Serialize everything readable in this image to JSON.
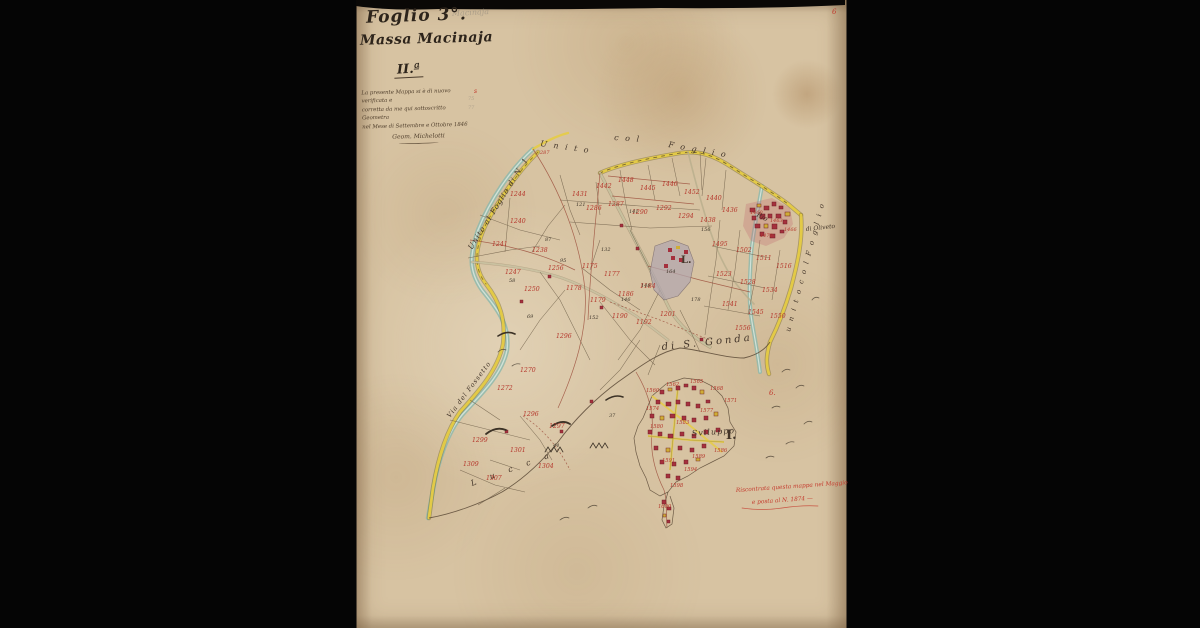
{
  "window": {
    "background": "#050505"
  },
  "sheet": {
    "paper_color": "#d7c3a2",
    "edge_color": "#0f0a06"
  },
  "title_block": {
    "sheet_no": "Foglio 3°.",
    "place_name": "Massa Macinaja",
    "series_mark": "II.ª",
    "certification_lines": [
      "La presente Mappa si è di nuovo verificata e",
      "corretta da me qui sottoscritto Geometra",
      "nel Mese di Settembre e Ottobre 1846"
    ],
    "signature": "Geom. Michelotti"
  },
  "map": {
    "colors": {
      "road_yellow": "#e6cc45",
      "stream_blue": "#8fb8ac",
      "building_red": "#a5303d",
      "building_yellow": "#cfad36",
      "ink": "#44362a",
      "red_number": "#b5372c",
      "gray_wash": "#b3a7ae"
    },
    "labels": [
      {
        "t": "U n i t o",
        "x": 540,
        "y": 146,
        "r": 8,
        "s": 8,
        "ls": 2
      },
      {
        "t": "c o l",
        "x": 614,
        "y": 140,
        "r": 4,
        "s": 8,
        "ls": 2
      },
      {
        "t": "F o g l i o",
        "x": 668,
        "y": 147,
        "r": 10,
        "s": 8,
        "ls": 2
      },
      {
        "t": "Unito al Foglio di N. 1",
        "x": 472,
        "y": 250,
        "r": -58,
        "s": 7.5,
        "ls": 1
      },
      {
        "t": "Via del Fossetto",
        "x": 450,
        "y": 418,
        "r": -53,
        "s": 6.5,
        "ls": 1
      },
      {
        "t": "L  u  c  c  a",
        "x": 472,
        "y": 486,
        "r": -20,
        "s": 8,
        "ls": 6
      },
      {
        "t": "di S. Gonda",
        "x": 662,
        "y": 350,
        "r": -6,
        "s": 10,
        "ls": 3
      },
      {
        "t": "u n i t o  c o l  F o g l i o",
        "x": 790,
        "y": 332,
        "r": -75,
        "s": 7,
        "ls": 2
      },
      {
        "t": "Rio",
        "x": 756,
        "y": 216,
        "r": 28,
        "s": 7
      },
      {
        "t": "di Oliveto",
        "x": 806,
        "y": 231,
        "r": -6,
        "s": 6
      },
      {
        "t": "Sviluppo",
        "x": 692,
        "y": 436,
        "r": -4,
        "s": 8,
        "ls": 1
      },
      {
        "t": "I.",
        "x": 726,
        "y": 439,
        "s": 13,
        "b": 1,
        "it": 0
      },
      {
        "t": "L.",
        "x": 681,
        "y": 263,
        "s": 10,
        "b": 1,
        "it": 0
      },
      {
        "t": "Macinaja",
        "x": 452,
        "y": 16,
        "s": 8,
        "c": "#8a8378",
        "o": 0.5,
        "r": -3
      },
      {
        "t": "75",
        "x": 468,
        "y": 100,
        "s": 5,
        "c": "#8a8378",
        "o": 0.5
      },
      {
        "t": "77",
        "x": 468,
        "y": 109,
        "s": 5,
        "c": "#8a8378",
        "o": 0.5
      },
      {
        "t": "6",
        "x": 832,
        "y": 14,
        "s": 7,
        "c": "#c23b2e"
      },
      {
        "t": "s",
        "x": 474,
        "y": 93,
        "s": 6,
        "c": "#c23b2e"
      },
      {
        "t": "6.",
        "x": 769,
        "y": 395,
        "s": 7,
        "c": "#c23b2e"
      },
      {
        "t": "Riscontrata questa mappa nel Maggio",
        "x": 736,
        "y": 492,
        "s": 5.8,
        "c": "#c4392c",
        "r": -4
      },
      {
        "t": "e posta al N. 1874 —",
        "x": 752,
        "y": 504,
        "s": 5.8,
        "c": "#c4392c",
        "r": -4
      }
    ],
    "parcel_numbers_red": [
      {
        "t": "287",
        "x": 540,
        "y": 154,
        "s": 5
      },
      {
        "t": "1431",
        "x": 572,
        "y": 196
      },
      {
        "t": "1442",
        "x": 596,
        "y": 188
      },
      {
        "t": "1448",
        "x": 618,
        "y": 182
      },
      {
        "t": "1445",
        "x": 640,
        "y": 190
      },
      {
        "t": "1446",
        "x": 662,
        "y": 186
      },
      {
        "t": "1452",
        "x": 684,
        "y": 194
      },
      {
        "t": "1440",
        "x": 706,
        "y": 200
      },
      {
        "t": "1286",
        "x": 586,
        "y": 210
      },
      {
        "t": "1287",
        "x": 608,
        "y": 206
      },
      {
        "t": "1290",
        "x": 632,
        "y": 214
      },
      {
        "t": "1292",
        "x": 656,
        "y": 210
      },
      {
        "t": "1294",
        "x": 678,
        "y": 218
      },
      {
        "t": "1438",
        "x": 700,
        "y": 222
      },
      {
        "t": "1436",
        "x": 722,
        "y": 212
      },
      {
        "t": "1244",
        "x": 510,
        "y": 196
      },
      {
        "t": "1240",
        "x": 510,
        "y": 223
      },
      {
        "t": "1241",
        "x": 492,
        "y": 246
      },
      {
        "t": "1238",
        "x": 532,
        "y": 252
      },
      {
        "t": "1256",
        "x": 548,
        "y": 270
      },
      {
        "t": "1247",
        "x": 505,
        "y": 274
      },
      {
        "t": "1250",
        "x": 524,
        "y": 291
      },
      {
        "t": "1175",
        "x": 582,
        "y": 268
      },
      {
        "t": "1177",
        "x": 604,
        "y": 276
      },
      {
        "t": "1178",
        "x": 566,
        "y": 290
      },
      {
        "t": "1179",
        "x": 590,
        "y": 302
      },
      {
        "t": "1186",
        "x": 618,
        "y": 296
      },
      {
        "t": "1184",
        "x": 640,
        "y": 288
      },
      {
        "t": "1190",
        "x": 612,
        "y": 318
      },
      {
        "t": "1192",
        "x": 636,
        "y": 324
      },
      {
        "t": "1201",
        "x": 660,
        "y": 316
      },
      {
        "t": "1296",
        "x": 556,
        "y": 338
      },
      {
        "t": "1270",
        "x": 520,
        "y": 372
      },
      {
        "t": "1272",
        "x": 497,
        "y": 390
      },
      {
        "t": "1296",
        "x": 523,
        "y": 416
      },
      {
        "t": "1297",
        "x": 549,
        "y": 428
      },
      {
        "t": "1299",
        "x": 472,
        "y": 442
      },
      {
        "t": "1301",
        "x": 510,
        "y": 452
      },
      {
        "t": "1304",
        "x": 538,
        "y": 468
      },
      {
        "t": "1307",
        "x": 486,
        "y": 480
      },
      {
        "t": "1309",
        "x": 463,
        "y": 466
      },
      {
        "t": "1495",
        "x": 712,
        "y": 246
      },
      {
        "t": "1502",
        "x": 736,
        "y": 252
      },
      {
        "t": "1511",
        "x": 756,
        "y": 260
      },
      {
        "t": "1516",
        "x": 776,
        "y": 268
      },
      {
        "t": "1523",
        "x": 716,
        "y": 276
      },
      {
        "t": "1528",
        "x": 740,
        "y": 284
      },
      {
        "t": "1534",
        "x": 762,
        "y": 292
      },
      {
        "t": "1541",
        "x": 722,
        "y": 306
      },
      {
        "t": "1545",
        "x": 748,
        "y": 314
      },
      {
        "t": "1550",
        "x": 770,
        "y": 318
      },
      {
        "t": "1556",
        "x": 735,
        "y": 330
      },
      {
        "t": "1460",
        "x": 750,
        "y": 214,
        "s": 5
      },
      {
        "t": "1463",
        "x": 770,
        "y": 222,
        "s": 5
      },
      {
        "t": "1466",
        "x": 784,
        "y": 231,
        "s": 5
      },
      {
        "t": "1470",
        "x": 760,
        "y": 237,
        "s": 5
      },
      {
        "t": "1560",
        "x": 646,
        "y": 392,
        "s": 5.2
      },
      {
        "t": "1562",
        "x": 666,
        "y": 386,
        "s": 5.2
      },
      {
        "t": "1565",
        "x": 690,
        "y": 383,
        "s": 5.2
      },
      {
        "t": "1568",
        "x": 710,
        "y": 390,
        "s": 5.2
      },
      {
        "t": "1571",
        "x": 724,
        "y": 402,
        "s": 5.2
      },
      {
        "t": "1574",
        "x": 646,
        "y": 410,
        "s": 5.2
      },
      {
        "t": "1577",
        "x": 700,
        "y": 412,
        "s": 5.2
      },
      {
        "t": "1580",
        "x": 650,
        "y": 428,
        "s": 5.2
      },
      {
        "t": "1583",
        "x": 676,
        "y": 424,
        "s": 5.2
      },
      {
        "t": "1586",
        "x": 714,
        "y": 452,
        "s": 5.2
      },
      {
        "t": "1589",
        "x": 692,
        "y": 458,
        "s": 5.2
      },
      {
        "t": "1591",
        "x": 662,
        "y": 462,
        "s": 5.2
      },
      {
        "t": "1594",
        "x": 684,
        "y": 471,
        "s": 5.2
      },
      {
        "t": "1598",
        "x": 670,
        "y": 487,
        "s": 5.2
      },
      {
        "t": "1600",
        "x": 658,
        "y": 508,
        "s": 5.2
      }
    ],
    "survey_numbers_black": [
      {
        "t": "95",
        "x": 560,
        "y": 262
      },
      {
        "t": "87",
        "x": 545,
        "y": 241
      },
      {
        "t": "132",
        "x": 601,
        "y": 251
      },
      {
        "t": "146",
        "x": 621,
        "y": 301
      },
      {
        "t": "148",
        "x": 641,
        "y": 287
      },
      {
        "t": "152",
        "x": 589,
        "y": 319
      },
      {
        "t": "164",
        "x": 666,
        "y": 273
      },
      {
        "t": "121",
        "x": 576,
        "y": 206
      },
      {
        "t": "141",
        "x": 629,
        "y": 213
      },
      {
        "t": "156",
        "x": 701,
        "y": 231
      },
      {
        "t": "178",
        "x": 691,
        "y": 301
      },
      {
        "t": "69",
        "x": 527,
        "y": 318
      },
      {
        "t": "58",
        "x": 509,
        "y": 282
      },
      {
        "t": "44",
        "x": 553,
        "y": 447
      },
      {
        "t": "37",
        "x": 609,
        "y": 417
      }
    ]
  }
}
